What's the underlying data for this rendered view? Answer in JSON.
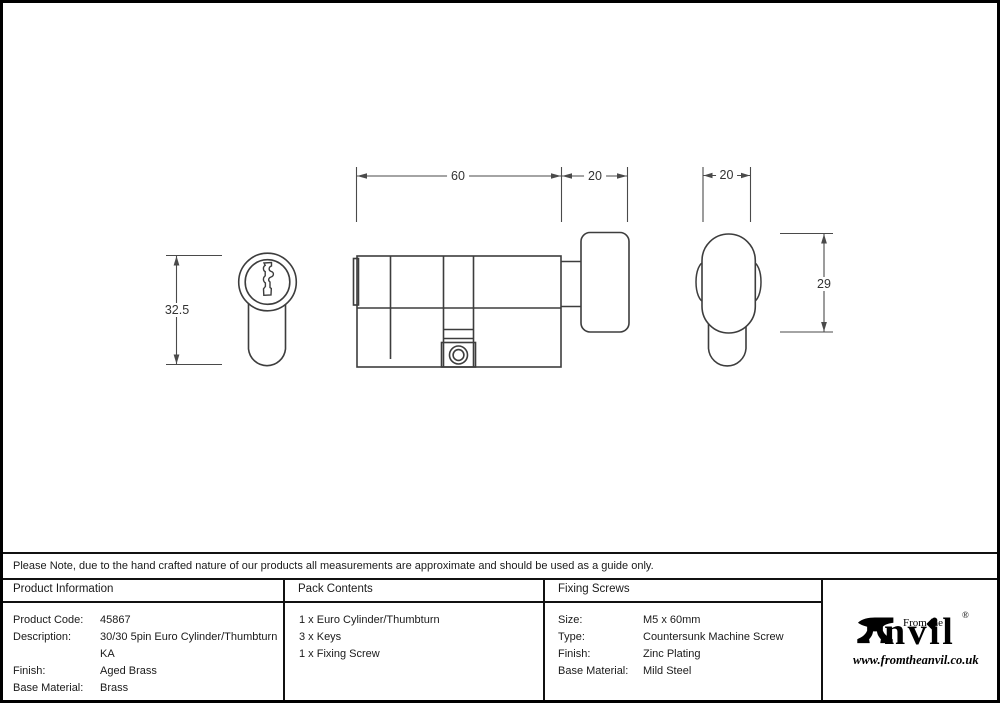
{
  "note": "Please Note, due to the hand crafted nature of our products all measurements are approximate and should be used as a guide only.",
  "drawing": {
    "dims": {
      "body_length": "60",
      "thumbturn_length": "20",
      "thumbturn_width": "20",
      "cylinder_height": "32.5",
      "thumbturn_height": "29"
    }
  },
  "product_info": {
    "header": "Product Information",
    "rows": [
      {
        "label": "Product Code:",
        "value": "45867"
      },
      {
        "label": "Description:",
        "value": "30/30 5pin Euro Cylinder/Thumbturn KA"
      },
      {
        "label": "Finish:",
        "value": "Aged Brass"
      },
      {
        "label": "Base Material:",
        "value": "Brass"
      }
    ]
  },
  "pack_contents": {
    "header": "Pack Contents",
    "items": [
      "1 x Euro Cylinder/Thumbturn",
      "3 x Keys",
      "1 x Fixing Screw"
    ]
  },
  "fixing_screws": {
    "header": "Fixing Screws",
    "rows": [
      {
        "label": "Size:",
        "value": "M5 x 60mm"
      },
      {
        "label": "Type:",
        "value": "Countersunk Machine Screw"
      },
      {
        "label": "Finish:",
        "value": "Zinc Plating"
      },
      {
        "label": "Base Material:",
        "value": "Mild Steel"
      }
    ]
  },
  "logo": {
    "prefix": "From the",
    "name_rest": "nvil",
    "registered": "®",
    "website": "www.fromtheanvil.co.uk"
  },
  "colors": {
    "object_line": "#3d3d3d",
    "dim_line": "#4a4a4a",
    "table_border": "#111111",
    "text": "#1a1a1a"
  }
}
